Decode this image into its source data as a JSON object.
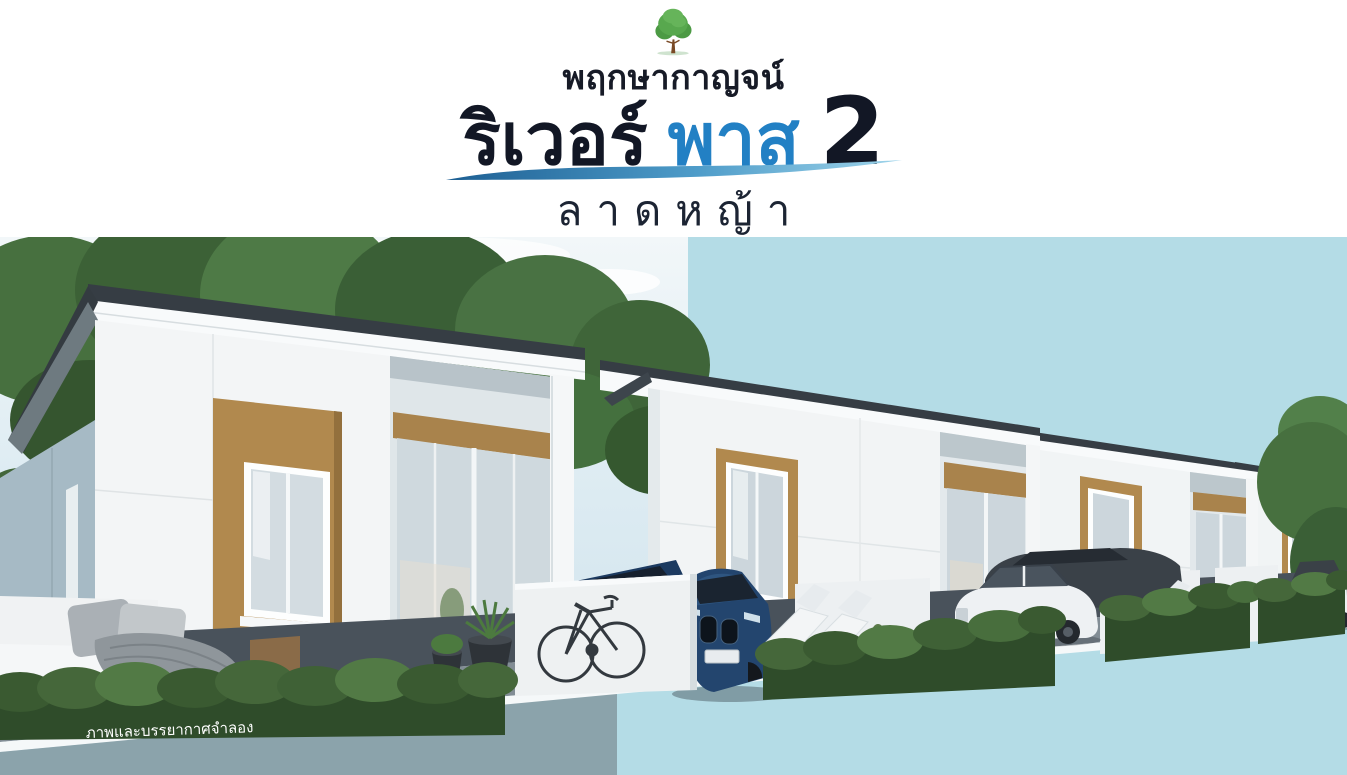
{
  "header": {
    "logo_icon": "tree-icon",
    "brand": "พฤกษากาญจน์",
    "title_part1": "ริเวอร์",
    "title_part2": "พาส",
    "title_number": "2",
    "subtitle": "ลาดหญ้า"
  },
  "scene": {
    "caption": "ภาพและบรรยากาศจำลอง",
    "elements": [
      "row-of-single-storey-townhouses",
      "navy-coupe-car",
      "white-sedan-car",
      "dark-hatchback-car",
      "white-suv-car",
      "bicycle",
      "white-fence-walls",
      "garden-hedges",
      "outdoor-sofa",
      "sun-loungers",
      "planter-pots",
      "trees",
      "paved-walkway",
      "road"
    ]
  },
  "colors": {
    "brand_text": "#171b27",
    "title_dark": "#121725",
    "title_blue": "#2280c4",
    "swoosh_dark": "#1d5f93",
    "swoosh_light": "#9fd4ea",
    "background_flat_blue": "#b4dce6",
    "road_gray": "#8ba3ab",
    "house_white": "#f4f6f7",
    "house_side_shadow": "#a6bac5",
    "accent_brown": "#b1894e",
    "roof_dark": "#363d44",
    "hedge_green": "#3f5d35",
    "pavement_dark": "#49525b",
    "car_navy": "#23456e"
  }
}
